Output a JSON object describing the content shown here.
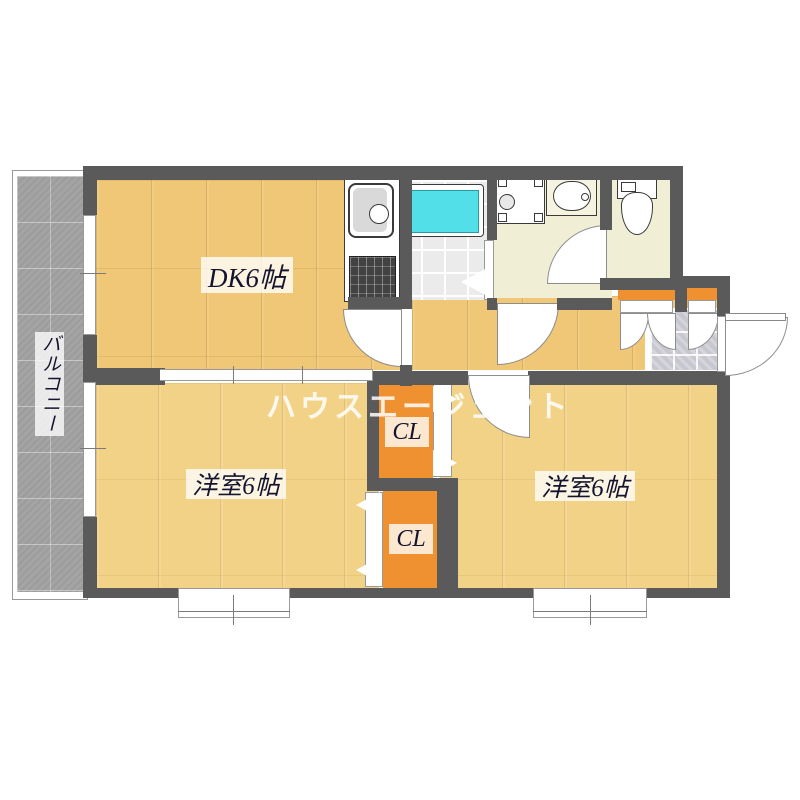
{
  "watermark": {
    "text": "ハウスエージェント"
  },
  "rooms": {
    "dk": {
      "label": "DK6帖"
    },
    "western_left": {
      "label": "洋室6帖"
    },
    "western_right": {
      "label": "洋室6帖"
    },
    "closet_upper": {
      "label": "CL"
    },
    "closet_lower": {
      "label": "CL"
    },
    "balcony": {
      "label": "バルコニー"
    }
  },
  "fixtures": {
    "kitchen_sink": "kitchen-sink",
    "gas_stove": "gas-stove",
    "bathtub": "bathtub",
    "washing_machine_pan": "washing-machine-pan",
    "vanity_basin": "vanity-basin",
    "toilet": "toilet",
    "shoe_cabinets": "shoe-cabinet",
    "entrance_door": "entrance-door",
    "windows": "sliding-window"
  },
  "colors": {
    "wall": "#5a5a5a",
    "floor_wood": "#efc776",
    "floor_wood_light": "#f2d286",
    "closet_orange": "#ef9130",
    "bathtub_cyan": "#53dfe7",
    "balcony_gray": "#a4a4a4",
    "washroom_cream": "#f1eed6",
    "bathroom_tile": "#ebebeb",
    "genkan_tile": "#c7c7cf"
  }
}
